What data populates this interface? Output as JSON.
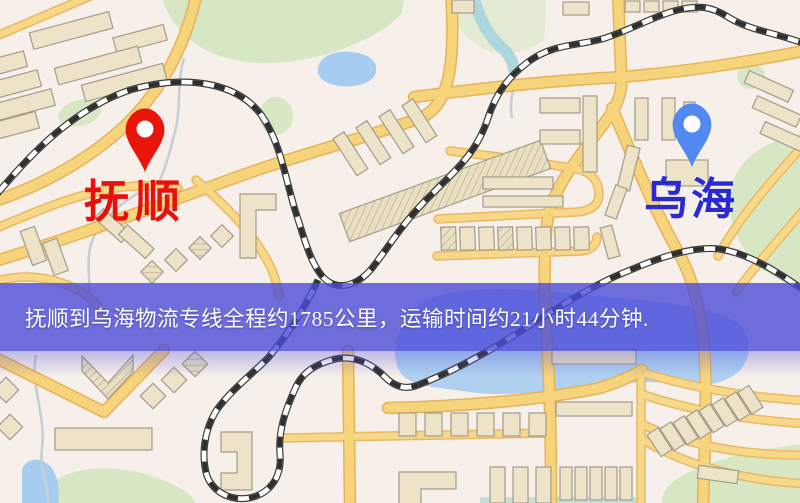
{
  "banner": {
    "text": "抚顺到乌海物流专线全程约1785公里，运输时间约21小时44分钟.",
    "background": "#4c4bd8",
    "text_color": "#ffffff"
  },
  "route": {
    "origin_city": "抚顺",
    "destination_city": "乌海",
    "distance_text": "约1785公里",
    "duration_text": "约21小时44分钟"
  },
  "markers": {
    "origin": {
      "city": "抚顺",
      "pin_color": "#e9150d",
      "label_color": "#e8100c"
    },
    "destination": {
      "city": "乌海",
      "pin_color": "#5289ee",
      "label_color": "#2a2ad2"
    }
  },
  "map": {
    "palette": {
      "background": "#f7f0ea",
      "road_fill": "#f6d47c",
      "road_casing": "#e7b25a",
      "building": "#ece3c8",
      "park": "#d7e7c3",
      "water": "#a6cdf0",
      "railway": "#3a3a3a"
    }
  }
}
